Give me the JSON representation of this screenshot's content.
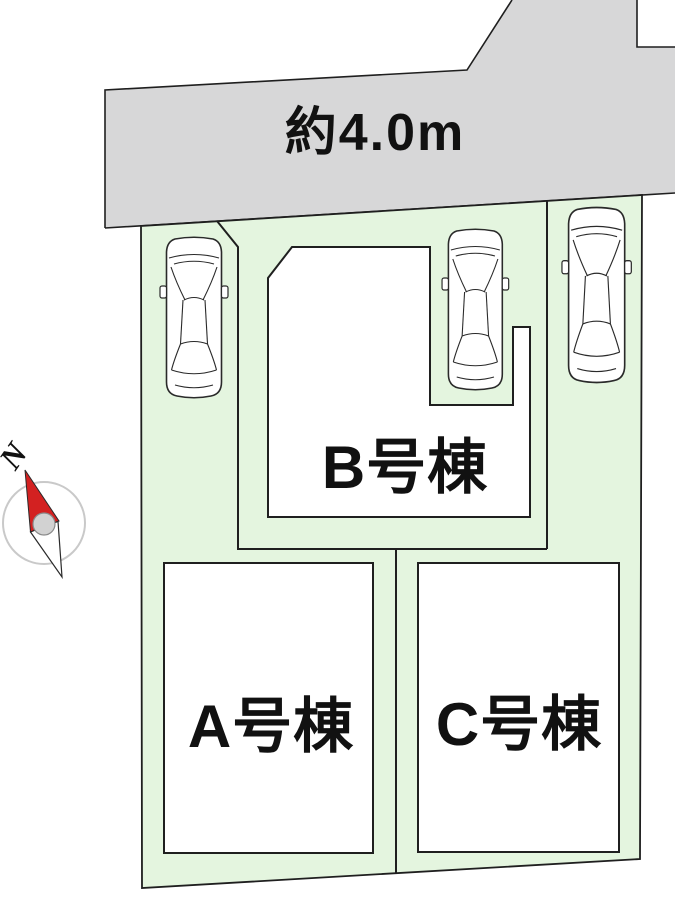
{
  "road": {
    "label": "約4.0m"
  },
  "buildings": [
    {
      "id": "A",
      "label": "A号棟"
    },
    {
      "id": "B",
      "label": "B号棟"
    },
    {
      "id": "C",
      "label": "C号棟"
    }
  ],
  "compass": {
    "north_label": "N"
  },
  "cars_count": 3,
  "colors": {
    "road_gray": "#d7d7d8",
    "plot_green": "#e4f5df",
    "building_white": "#ffffff",
    "outline": "#1f1f1f",
    "needle_red": "#d32121",
    "compass_ring": "#c9c9c9"
  }
}
